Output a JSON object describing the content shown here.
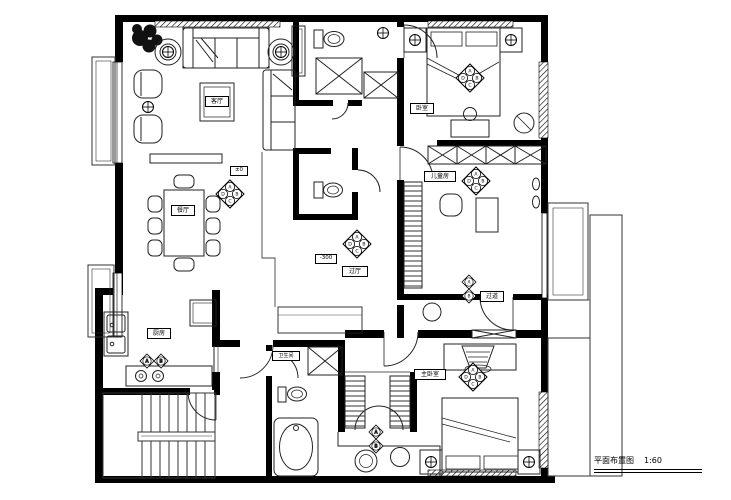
{
  "title": {
    "text": "平面布置图",
    "scale": "1:60"
  },
  "rooms": {
    "living": "客厅",
    "dining": "餐厅",
    "kitchen": "厨房",
    "bedroom": "卧室",
    "kids": "儿童房",
    "master": "主卧室",
    "bath": "卫生间",
    "hall": "过厅",
    "corridor": "过道"
  },
  "levels": {
    "zero": "±0",
    "minus300": "-300"
  },
  "markers": {
    "top": "A",
    "right": "B",
    "bottom": "C",
    "left": "D",
    "a": "A",
    "b": "B"
  },
  "colors": {
    "wall": "#000000",
    "line": "#2a2a2a",
    "bg": "#ffffff"
  }
}
